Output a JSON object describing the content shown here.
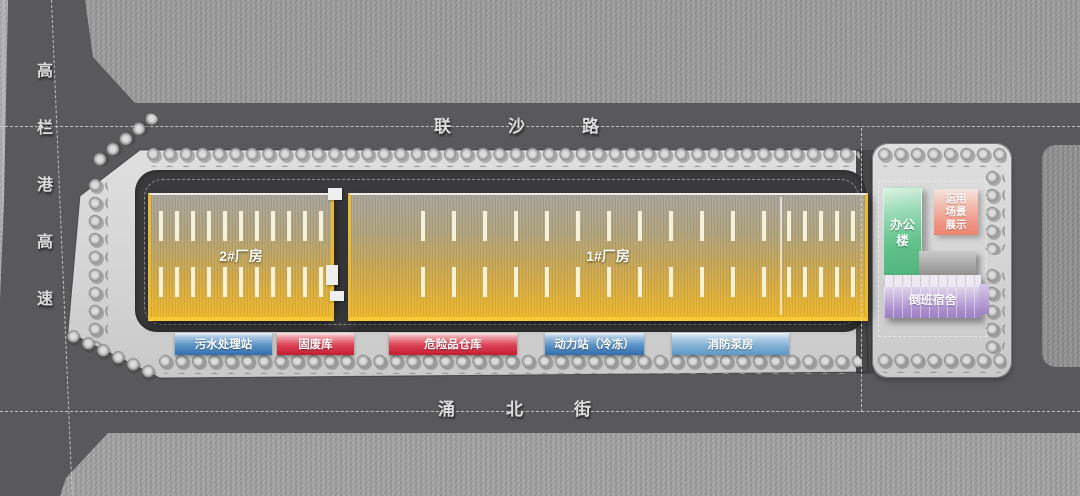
{
  "palette": {
    "road_gray": "#59595b",
    "terrain_gray": "#9a9a9a",
    "site_platform": "#d6d6d6",
    "ring_road": "#3b3b3d",
    "factory_gold": "#edb72b",
    "label_blue": "#3f7ab5",
    "label_red": "#c41d31",
    "label_light_blue": "#6aa0cc",
    "office_green": "#52b87a",
    "display_pink": "#ee9180",
    "dorm_purple": "#a184c6"
  },
  "roads": {
    "expressway": {
      "label": "高栏港高速",
      "orientation": "vertical"
    },
    "north": {
      "label": "联沙路",
      "orientation": "horizontal"
    },
    "south": {
      "label": "涌北街",
      "orientation": "horizontal"
    }
  },
  "site": {
    "factory_2": {
      "label": "2#厂房"
    },
    "factory_1": {
      "label": "1#厂房"
    },
    "facilities": [
      {
        "label": "污水处理站",
        "color": "#3f7ab5"
      },
      {
        "label": "固废库",
        "color": "#c41d31"
      },
      {
        "label": "危险品仓库",
        "color": "#c41d31"
      },
      {
        "label": "动力站（冷冻）",
        "color": "#3f7ab5"
      },
      {
        "label": "消防泵房",
        "color": "#6aa0cc"
      }
    ]
  },
  "annex": {
    "office": {
      "lines": [
        "办公",
        "楼"
      ],
      "color": "#52b87a"
    },
    "scene_display": {
      "lines": [
        "运用",
        "场景",
        "展示"
      ],
      "color": "#ee9180"
    },
    "dormitory": {
      "label": "倒班宿舍",
      "color": "#a184c6"
    }
  }
}
